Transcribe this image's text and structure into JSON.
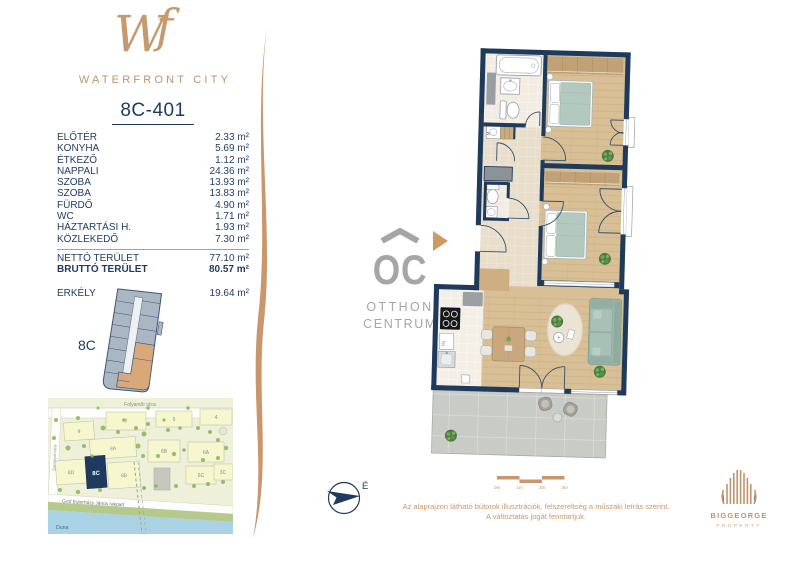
{
  "brand": {
    "monogram_w": "W",
    "monogram_f": "f",
    "name": "WATERFRONT CITY"
  },
  "unit": {
    "title": "8C-401"
  },
  "area_table": {
    "rows": [
      {
        "label": "ELŐTÉR",
        "value": "2.33 m²"
      },
      {
        "label": "KONYHA",
        "value": "5.69 m²"
      },
      {
        "label": "ÉTKEZŐ",
        "value": "1.12 m²"
      },
      {
        "label": "NAPPALI",
        "value": "24.36 m²"
      },
      {
        "label": "SZOBA",
        "value": "13.93 m²"
      },
      {
        "label": "SZOBA",
        "value": "13.83 m²"
      },
      {
        "label": "FÜRDŐ",
        "value": "4.90 m²"
      },
      {
        "label": "WC",
        "value": "1.71 m²"
      },
      {
        "label": "HÁZTARTÁSI H.",
        "value": "1.93 m²"
      },
      {
        "label": "KÖZLEKEDŐ",
        "value": "7.30 m²"
      }
    ],
    "totals": [
      {
        "label": "NETTÓ TERÜLET",
        "value": "77.10 m²"
      },
      {
        "label": "BRUTTÓ TERÜLET",
        "value": "80.57 m²"
      }
    ],
    "balcony": {
      "label": "ERKÉLY",
      "value": "19.64 m²"
    }
  },
  "mini_plan": {
    "label": "8C"
  },
  "map": {
    "street_top": "Folyamőr utca",
    "street_left": "Sorompó utca",
    "street_river": "Gróf Esterházy János rakpart",
    "river": "Duna",
    "highlight": "8C",
    "buildings": [
      "9",
      "7",
      "5",
      "4",
      "8A",
      "6B",
      "6A",
      "8D",
      "8B",
      "6C",
      "3C"
    ]
  },
  "floor_plan": {
    "washer_label": "M",
    "appliance_label": "Mg"
  },
  "compass": {
    "north_label": "É"
  },
  "scale_bar": {
    "labels": [
      "0m",
      "1m",
      "2m",
      "3m"
    ]
  },
  "oc_logo": {
    "monogram": "OC",
    "line1": "OTTHON",
    "line2": "CENTRUM"
  },
  "disclaimer": {
    "line1": "Az alaprajzon látható bútorok illusztrációk, felszereltség a műszaki leírás szerint.",
    "line2": "A változtatás jogát fenntartjuk."
  },
  "developer_logo": {
    "name": "BIGGEORGE",
    "subtitle": "PROPERTY"
  },
  "colors": {
    "navy": "#1f3a5f",
    "tan": "#c9976b",
    "logo_gray": "#a6a6a6",
    "wall": "#1e3a5c"
  }
}
